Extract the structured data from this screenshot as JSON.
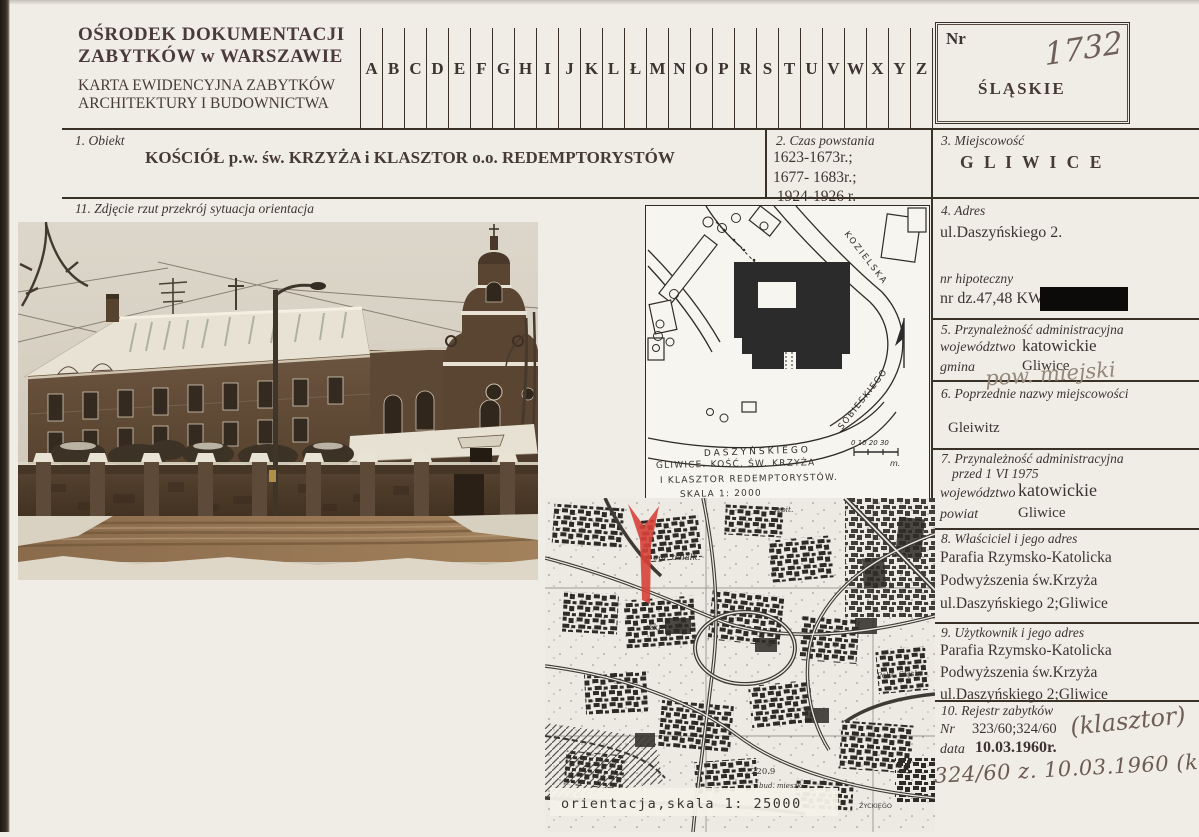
{
  "header": {
    "org_line1": "OŚRODEK  DOKUMENTACJI",
    "org_line2": "ZABYTKÓW  w  WARSZAWIE",
    "card_line1": "KARTA EWIDENCYJNA ZABYTKÓW",
    "card_line2": "ARCHITEKTURY  I  BUDOWNICTWA",
    "alphabet": [
      "A",
      "B",
      "C",
      "D",
      "E",
      "F",
      "G",
      "H",
      "I",
      "J",
      "K",
      "L",
      "Ł",
      "M",
      "N",
      "O",
      "P",
      "R",
      "S",
      "T",
      "U",
      "V",
      "W",
      "X",
      "Y",
      "Z"
    ],
    "nr_label": "Nr",
    "nr_value_handwritten": "1732",
    "voivodeship_stamp": "ŚLĄSKIE"
  },
  "sections": {
    "s1": {
      "label": "1.  Obiekt",
      "title": "KOŚCIÓŁ p.w. św. KRZYŻA  i  KLASZTOR  o.o. REDEMPTORYSTÓW"
    },
    "s2": {
      "label": "2.  Czas powstania",
      "lines": [
        "1623-1673r.;",
        "1677- 1683r.;",
        " 1924-1926 r."
      ]
    },
    "s3": {
      "label": "3.  Miejscowość",
      "value": "G L I W I C E"
    },
    "s4": {
      "label": "4.  Adres",
      "address": "ul.Daszyńskiego 2.",
      "mortgage_label": "nr hipoteczny",
      "parcel": "nr dz.47,48   KW"
    },
    "s5": {
      "label": "5.  Przynależność administracyjna",
      "voivodeship_label": "województwo",
      "voivodeship": "katowickie",
      "commune_label": "gmina",
      "commune": "Gliwice",
      "handwritten": "pow. miejski"
    },
    "s6": {
      "label": "6.  Poprzednie nazwy miejscowości",
      "value": "Gleiwitz"
    },
    "s7": {
      "label": "7.  Przynależność administracyjna",
      "label2": "przed 1 VI 1975",
      "voivodeship_label": "województwo",
      "voivodeship": "katowickie",
      "district_label": "powiat",
      "district": "Gliwice"
    },
    "s8": {
      "label": "8.  Właściciel i jego adres",
      "lines": [
        "Parafia  Rzymsko-Katolicka",
        "Podwyższenia św.Krzyża",
        "ul.Daszyńskiego 2;Gliwice"
      ]
    },
    "s9": {
      "label": "9.  Użytkownik  i jego adres",
      "lines": [
        "Parafia  Rzymsko-Katolicka",
        "Podwyższenia św.Krzyża",
        "ul.Daszyńskiego 2;Gliwice"
      ]
    },
    "s10": {
      "label": "10.  Rejestr zabytków",
      "nr_label": "Nr",
      "nr_value": "323/60;324/60",
      "nr_note_handwritten": "(klasztor)",
      "date_label": "data",
      "date_value": "10.03.1960r.",
      "handwritten_note": "324/60 z. 10.03.1960 (kościół)"
    },
    "s11": {
      "label": "11.  Zdjęcie rzut przekrój sytuacja orientacja"
    }
  },
  "site_plan": {
    "street_kozielska": "KOZIELSKA",
    "street_daszynskiego": "DASZYŃSKIEGO",
    "street_sobieskiego": "SOBIESKIEGO",
    "caption_line1": "GLIWICE. KOŚĆ. ŚW. KRZYŻA",
    "caption_line2": "I KLASZTOR REDEMPTORYSTÓW.",
    "caption_line3": "SKALA  1: 2000",
    "scale_ticks": "0    10    20    30",
    "scale_unit": "m."
  },
  "orientation_map": {
    "caption": "orientacja,skala 1: 25000",
    "labels": {
      "allotments": "ogr. dzialk.",
      "school": "szk.",
      "hospital": "szpit.",
      "university": "Polit. Śląska",
      "elevation1": "230.7",
      "elevation2": "220.9",
      "housing": "bud. mieszk.",
      "street": "ŻYCKIEGO"
    }
  },
  "colors": {
    "red_arrow": "#d8423a",
    "ink": "#3a3127",
    "stamp_ink": "#473a36"
  }
}
